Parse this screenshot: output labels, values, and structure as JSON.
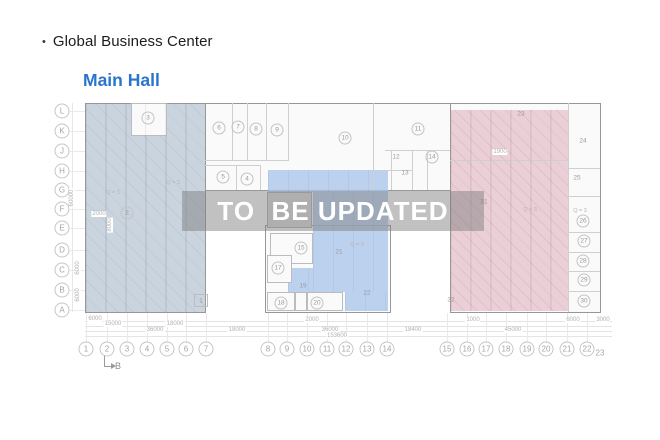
{
  "header": {
    "bullet": "•",
    "title": "Global Business Center",
    "subtitle": "Main Hall"
  },
  "watermark": {
    "text": "TO  BE UPDATED"
  },
  "colors": {
    "accent_blue": "#2B74CC",
    "zone_left": "#CAD4DF",
    "zone_mid_blue": "#B7CCE9",
    "zone_right_pink": "#EACFD7",
    "watermark_band": "#7D7D7D"
  },
  "plan": {
    "b_marker": "B",
    "row_labels": [
      {
        "t": "L",
        "y": 111
      },
      {
        "t": "K",
        "y": 131
      },
      {
        "t": "J",
        "y": 151
      },
      {
        "t": "H",
        "y": 171
      },
      {
        "t": "G",
        "y": 190
      },
      {
        "t": "F",
        "y": 209
      },
      {
        "t": "E",
        "y": 228
      },
      {
        "t": "D",
        "y": 250
      },
      {
        "t": "C",
        "y": 270
      },
      {
        "t": "B",
        "y": 290
      },
      {
        "t": "A",
        "y": 310
      }
    ],
    "col_labels": [
      {
        "t": "1",
        "x": 86
      },
      {
        "t": "2",
        "x": 107
      },
      {
        "t": "3",
        "x": 127
      },
      {
        "t": "4",
        "x": 147
      },
      {
        "t": "5",
        "x": 167
      },
      {
        "t": "6",
        "x": 186
      },
      {
        "t": "7",
        "x": 206
      },
      {
        "t": "8",
        "x": 268
      },
      {
        "t": "9",
        "x": 287
      },
      {
        "t": "10",
        "x": 307
      },
      {
        "t": "11",
        "x": 327
      },
      {
        "t": "12",
        "x": 346
      },
      {
        "t": "13",
        "x": 367
      },
      {
        "t": "14",
        "x": 387
      },
      {
        "t": "15",
        "x": 447
      },
      {
        "t": "16",
        "x": 467
      },
      {
        "t": "17",
        "x": 486
      },
      {
        "t": "18",
        "x": 506
      },
      {
        "t": "19",
        "x": 527
      },
      {
        "t": "20",
        "x": 546
      },
      {
        "t": "21",
        "x": 567
      },
      {
        "t": "22",
        "x": 587
      }
    ],
    "col23": {
      "t": "23",
      "x": 600,
      "y": 353
    },
    "rooms_circled": [
      {
        "t": "3",
        "x": 148,
        "y": 118
      },
      {
        "t": "2",
        "x": 127,
        "y": 213
      },
      {
        "t": "6",
        "x": 219,
        "y": 128
      },
      {
        "t": "7",
        "x": 238,
        "y": 127
      },
      {
        "t": "8",
        "x": 256,
        "y": 129
      },
      {
        "t": "9",
        "x": 277,
        "y": 130
      },
      {
        "t": "10",
        "x": 345,
        "y": 138
      },
      {
        "t": "11",
        "x": 418,
        "y": 129
      },
      {
        "t": "14",
        "x": 432,
        "y": 157
      },
      {
        "t": "5",
        "x": 223,
        "y": 177
      },
      {
        "t": "4",
        "x": 247,
        "y": 179
      },
      {
        "t": "15",
        "x": 301,
        "y": 248
      },
      {
        "t": "17",
        "x": 278,
        "y": 268
      },
      {
        "t": "18",
        "x": 281,
        "y": 303
      },
      {
        "t": "20",
        "x": 317,
        "y": 303
      },
      {
        "t": "26",
        "x": 583,
        "y": 221
      },
      {
        "t": "27",
        "x": 584,
        "y": 241
      },
      {
        "t": "28",
        "x": 583,
        "y": 261
      },
      {
        "t": "29",
        "x": 584,
        "y": 280
      },
      {
        "t": "30",
        "x": 584,
        "y": 301
      }
    ],
    "rooms_plain": [
      {
        "t": "1",
        "x": 201,
        "y": 301
      },
      {
        "t": "12",
        "x": 396,
        "y": 157
      },
      {
        "t": "13",
        "x": 405,
        "y": 173
      },
      {
        "t": "19",
        "x": 303,
        "y": 286
      },
      {
        "t": "21",
        "x": 339,
        "y": 252
      },
      {
        "t": "22",
        "x": 367,
        "y": 293
      },
      {
        "t": "23",
        "x": 521,
        "y": 114
      },
      {
        "t": "24",
        "x": 583,
        "y": 141
      },
      {
        "t": "25",
        "x": 577,
        "y": 178
      },
      {
        "t": "31",
        "x": 484,
        "y": 202
      },
      {
        "t": "32",
        "x": 451,
        "y": 300
      }
    ],
    "q_labels": [
      {
        "t": "Q = 3",
        "x": 113,
        "y": 193
      },
      {
        "t": "Q = 3",
        "x": 173,
        "y": 183
      },
      {
        "t": "Q = 3",
        "x": 357,
        "y": 245
      },
      {
        "t": "Q = 3",
        "x": 530,
        "y": 210
      },
      {
        "t": "Q = 3",
        "x": 580,
        "y": 211
      }
    ],
    "dims": [
      {
        "t": "6000",
        "x": 95,
        "y": 319
      },
      {
        "t": "2000",
        "x": 312,
        "y": 320
      },
      {
        "t": "1000",
        "x": 473,
        "y": 320
      },
      {
        "t": "6000",
        "x": 573,
        "y": 320
      },
      {
        "t": "3000",
        "x": 603,
        "y": 320
      },
      {
        "t": "15000",
        "x": 113,
        "y": 324
      },
      {
        "t": "18000",
        "x": 175,
        "y": 324
      },
      {
        "t": "36000",
        "x": 155,
        "y": 330
      },
      {
        "t": "18000",
        "x": 237,
        "y": 330
      },
      {
        "t": "36000",
        "x": 330,
        "y": 330
      },
      {
        "t": "18400",
        "x": 413,
        "y": 330
      },
      {
        "t": "45000",
        "x": 513,
        "y": 330
      },
      {
        "t": "153600",
        "x": 337,
        "y": 336
      },
      {
        "t": "2000",
        "x": 99,
        "y": 214
      },
      {
        "t": "1900",
        "x": 500,
        "y": 152
      }
    ],
    "vdims": [
      {
        "t": "60000",
        "x": 72,
        "y": 198
      },
      {
        "t": "6000",
        "x": 78,
        "y": 268
      },
      {
        "t": "6000",
        "x": 78,
        "y": 295
      },
      {
        "t": "8000",
        "x": 110,
        "y": 225
      }
    ],
    "walls": [
      {
        "x": 232,
        "y": 103,
        "w": 1,
        "h": 57
      },
      {
        "x": 247,
        "y": 103,
        "w": 1,
        "h": 57
      },
      {
        "x": 266,
        "y": 103,
        "w": 1,
        "h": 57
      },
      {
        "x": 288,
        "y": 103,
        "w": 1,
        "h": 57
      },
      {
        "x": 205,
        "y": 160,
        "w": 84,
        "h": 1
      },
      {
        "x": 373,
        "y": 103,
        "w": 1,
        "h": 87
      },
      {
        "x": 385,
        "y": 150,
        "w": 65,
        "h": 1
      },
      {
        "x": 391,
        "y": 150,
        "w": 1,
        "h": 40
      },
      {
        "x": 412,
        "y": 150,
        "w": 1,
        "h": 40
      },
      {
        "x": 427,
        "y": 150,
        "w": 1,
        "h": 40
      },
      {
        "x": 385,
        "y": 170,
        "w": 27,
        "h": 1
      },
      {
        "x": 205,
        "y": 165,
        "w": 55,
        "h": 1
      },
      {
        "x": 236,
        "y": 165,
        "w": 1,
        "h": 25
      },
      {
        "x": 260,
        "y": 165,
        "w": 1,
        "h": 25
      },
      {
        "x": 568,
        "y": 103,
        "w": 1,
        "h": 209
      },
      {
        "x": 568,
        "y": 168,
        "w": 32,
        "h": 1
      },
      {
        "x": 568,
        "y": 196,
        "w": 32,
        "h": 1
      },
      {
        "x": 568,
        "y": 232,
        "w": 32,
        "h": 1
      },
      {
        "x": 568,
        "y": 252,
        "w": 32,
        "h": 1
      },
      {
        "x": 568,
        "y": 271,
        "w": 32,
        "h": 1
      },
      {
        "x": 568,
        "y": 291,
        "w": 32,
        "h": 1
      },
      {
        "x": 450,
        "y": 160,
        "w": 118,
        "h": 1
      }
    ],
    "walls_faint": [
      {
        "x": 105,
        "y": 103,
        "w": 1,
        "h": 209
      },
      {
        "x": 125,
        "y": 103,
        "w": 1,
        "h": 209
      },
      {
        "x": 145,
        "y": 103,
        "w": 1,
        "h": 209
      },
      {
        "x": 165,
        "y": 103,
        "w": 1,
        "h": 209
      },
      {
        "x": 185,
        "y": 103,
        "w": 1,
        "h": 209
      },
      {
        "x": 470,
        "y": 110,
        "w": 1,
        "h": 201
      },
      {
        "x": 490,
        "y": 110,
        "w": 1,
        "h": 201
      },
      {
        "x": 510,
        "y": 110,
        "w": 1,
        "h": 201
      },
      {
        "x": 530,
        "y": 110,
        "w": 1,
        "h": 201
      },
      {
        "x": 550,
        "y": 110,
        "w": 1,
        "h": 201
      }
    ]
  }
}
